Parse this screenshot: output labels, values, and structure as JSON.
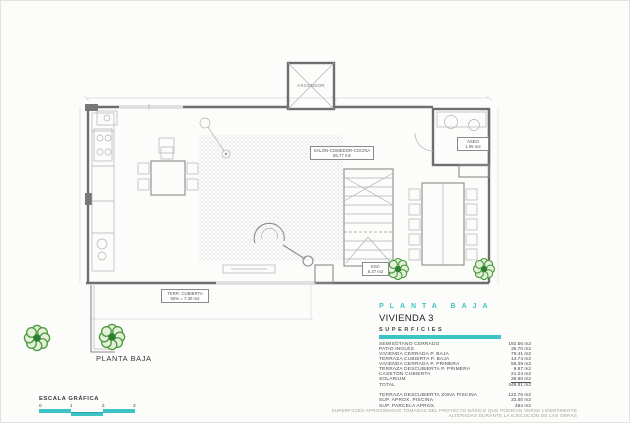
{
  "colors": {
    "accent_teal": "#3cc4c4",
    "tree_green": "#4c9b3e"
  },
  "plan": {
    "labels": {
      "elevator": "ASCENSOR",
      "living": {
        "title": "SALÓN-COMEDOR-COCINA",
        "area": "55,77 m2"
      },
      "toilet": {
        "title": "ASEO",
        "area": "1.95 m2"
      },
      "stairs": {
        "title": "ESC",
        "area": "6.37 m2"
      },
      "covered_terrace": {
        "title": "TERR. CUBIERTA",
        "area": "50% = 7.30 m2"
      },
      "caption": "PLANTA BAJA"
    }
  },
  "legend": {
    "heading": "PLANTA BAJA",
    "dwelling": "VIVIENDA 3",
    "subheading": "SUPERFICIES",
    "rows": [
      {
        "label": "SEMISÓTANO CERRADO",
        "value": "192.56 m2"
      },
      {
        "label": "PATIO INGLÉS",
        "value": "35.70 m2"
      },
      {
        "label": "VIVIENDA CERRADA P. BAJA",
        "value": "79.41 m2"
      },
      {
        "label": "TERRAZA CUBIERTA P. BAJA",
        "value": "14.74 m2"
      },
      {
        "label": "VIVIENDA CERRADA P. PRIMERA",
        "value": "56.39 m2"
      },
      {
        "label": "TERRAZA DESCUBIERTA P. PRIMERA",
        "value": "9.87 m2"
      },
      {
        "label": "CASETÓN CUBIERTA",
        "value": "21.24 m2"
      },
      {
        "label": "SOLARIUM",
        "value": "39.90 m2"
      },
      {
        "label": "TOTAL",
        "value": "449.81 m2"
      }
    ],
    "extra_rows": [
      {
        "label": "TERRAZA DESCUBIERTA  ZONA PISCINA",
        "value": "122.76 m2"
      },
      {
        "label": "SUP.  APROX.  PISCINA",
        "value": "33.50 m2"
      },
      {
        "label": "SUP. PARCELA APROX.",
        "value": "494 m2"
      }
    ]
  },
  "scale_bar": {
    "label": "ESCALA GRÁFICA",
    "ticks": [
      "0",
      "1",
      "2",
      "3"
    ]
  },
  "footer": {
    "disclaimer": "SUPERFICIES APROXIMADAS TOMADAS DEL PROYECTO BÁSICO QUE PODRÍAN VERSE LIGERAMENTE ALTERADAS DURANTE LA EJECUCIÓN DE LAS OBRAS"
  }
}
